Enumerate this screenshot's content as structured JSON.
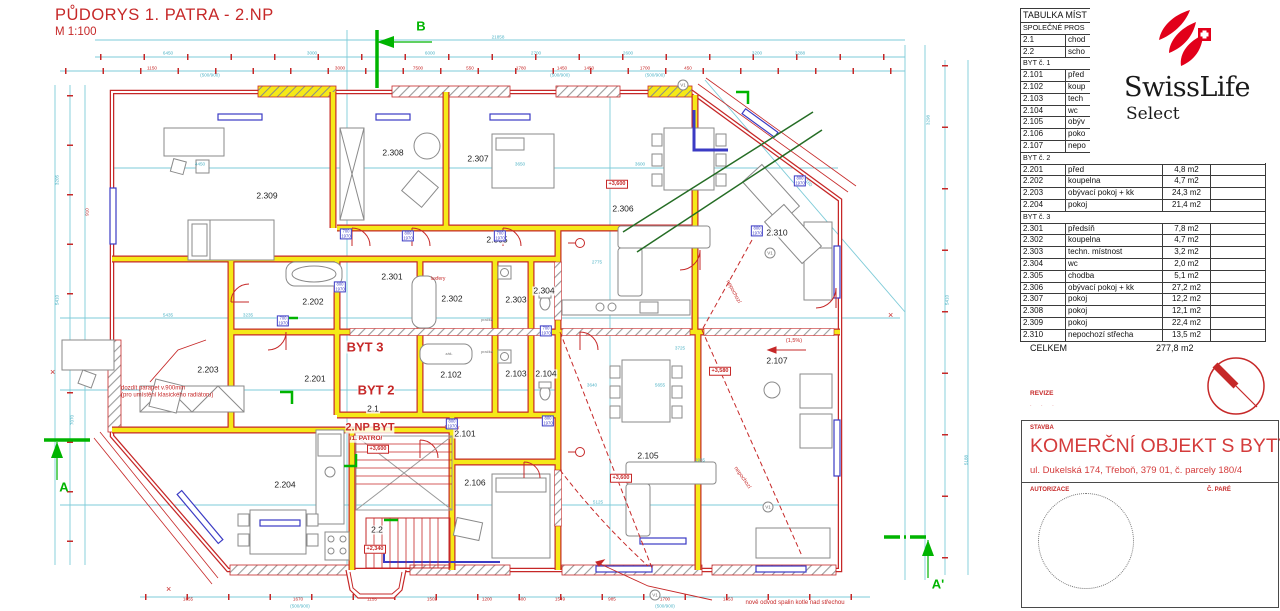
{
  "drawing": {
    "title": "PŮDORYS  1. PATRA - 2.NP",
    "scale": "M 1:100"
  },
  "logo": {
    "brand": "SwissLife",
    "sub": "Select"
  },
  "table": {
    "header": "TABULKA MÍST",
    "rows": [
      {
        "section": "SPOLEČNÉ PROS"
      },
      {
        "id": "2.1",
        "name": "chod",
        "area": ""
      },
      {
        "id": "2.2",
        "name": "scho",
        "area": ""
      },
      {
        "section": "BYT č. 1"
      },
      {
        "id": "2.101",
        "name": "před",
        "area": ""
      },
      {
        "id": "2.102",
        "name": "koup",
        "area": ""
      },
      {
        "id": "2.103",
        "name": "tech",
        "area": ""
      },
      {
        "id": "2.104",
        "name": "wc",
        "area": ""
      },
      {
        "id": "2.105",
        "name": "obýv",
        "area": ""
      },
      {
        "id": "2.106",
        "name": "poko",
        "area": ""
      },
      {
        "id": "2.107",
        "name": "nepo",
        "area": ""
      },
      {
        "section": "BYT č. 2"
      },
      {
        "id": "2.201",
        "name": "před",
        "area": "4,8 m2"
      },
      {
        "id": "2.202",
        "name": "koupelna",
        "area": "4,7 m2"
      },
      {
        "id": "2.203",
        "name": "obývací pokoj + kk",
        "area": "24,3 m2"
      },
      {
        "id": "2.204",
        "name": "pokoj",
        "area": "21,4 m2"
      },
      {
        "section": "BYT č. 3"
      },
      {
        "id": "2.301",
        "name": "předsíň",
        "area": "7,8 m2"
      },
      {
        "id": "2.302",
        "name": "koupelna",
        "area": "4,7 m2"
      },
      {
        "id": "2.303",
        "name": "techn. místnost",
        "area": "3,2 m2"
      },
      {
        "id": "2.304",
        "name": "wc",
        "area": "2,0 m2"
      },
      {
        "id": "2.305",
        "name": "chodba",
        "area": "5,1 m2"
      },
      {
        "id": "2.306",
        "name": "obývací pokoj + kk",
        "area": "27,2 m2"
      },
      {
        "id": "2.307",
        "name": "pokoj",
        "area": "12,2 m2"
      },
      {
        "id": "2.308",
        "name": "pokoj",
        "area": "12,1 m2"
      },
      {
        "id": "2.309",
        "name": "pokoj",
        "area": "22,4 m2"
      },
      {
        "id": "2.310",
        "name": "nepochozí střecha",
        "area": "13,5 m2"
      }
    ],
    "total_label": "CELKEM",
    "total_value": "277,8 m2"
  },
  "revize": {
    "label": "REVIZE",
    "marks": "·  ·        ·"
  },
  "title_block": {
    "stavba_label": "STAVBA",
    "title": "KOMERČNÍ OBJEKT S BYTY",
    "address": "ul. Dukelská 174, Třeboň, 379 01, č. parcely 180/4",
    "autorizace_label": "AUTORIZACE",
    "pare_label": "Č. PARÉ"
  },
  "colors": {
    "red": "#c62828",
    "cyan": "#7ecbd8",
    "blue": "#3b3bc4",
    "yellow": "#f5e918",
    "green": "#00b400",
    "logo_red": "#e2001a"
  },
  "plan": {
    "rooms": [
      {
        "t": "2.309",
        "x": 267,
        "y": 196
      },
      {
        "t": "2.308",
        "x": 393,
        "y": 153
      },
      {
        "t": "2.307",
        "x": 478,
        "y": 159
      },
      {
        "t": "2.306",
        "x": 623,
        "y": 209
      },
      {
        "t": "2.310",
        "x": 777,
        "y": 233
      },
      {
        "t": "2.305",
        "x": 497,
        "y": 240
      },
      {
        "t": "2.301",
        "x": 392,
        "y": 277
      },
      {
        "t": "2.202",
        "x": 313,
        "y": 302
      },
      {
        "t": "2.302",
        "x": 452,
        "y": 299
      },
      {
        "t": "2.303",
        "x": 516,
        "y": 300
      },
      {
        "t": "2.304",
        "x": 544,
        "y": 291
      },
      {
        "t": "2.203",
        "x": 208,
        "y": 370
      },
      {
        "t": "2.201",
        "x": 315,
        "y": 379
      },
      {
        "t": "2.102",
        "x": 451,
        "y": 375
      },
      {
        "t": "2.103",
        "x": 516,
        "y": 374
      },
      {
        "t": "2.104",
        "x": 546,
        "y": 374
      },
      {
        "t": "2.1",
        "x": 373,
        "y": 409
      },
      {
        "t": "2.101",
        "x": 465,
        "y": 434
      },
      {
        "t": "2.106",
        "x": 475,
        "y": 483
      },
      {
        "t": "2.204",
        "x": 285,
        "y": 485
      },
      {
        "t": "2.105",
        "x": 648,
        "y": 456
      },
      {
        "t": "2.107",
        "x": 777,
        "y": 361
      },
      {
        "t": "2.2",
        "x": 377,
        "y": 530
      }
    ],
    "apartments": [
      {
        "t": "BYT 3",
        "x": 365,
        "y": 347,
        "fs": 13
      },
      {
        "t": "BYT 2",
        "x": 376,
        "y": 390,
        "fs": 13
      },
      {
        "t": "2.NP BYT",
        "x": 370,
        "y": 428,
        "fs": 11
      },
      {
        "t": "/1. PATRO/",
        "x": 366,
        "y": 439,
        "fs": 6.5
      }
    ],
    "elevations": [
      {
        "t": "+3,600",
        "x": 617,
        "y": 184
      },
      {
        "t": "+3,600",
        "x": 621,
        "y": 478
      },
      {
        "t": "+3,580",
        "x": 720,
        "y": 371
      },
      {
        "t": "+3,600",
        "x": 378,
        "y": 449
      },
      {
        "t": "+2,340",
        "x": 375,
        "y": 549
      }
    ],
    "annotations": [
      {
        "t": "dozdít parapet v.900mm\n(pro umístění klasického radiátoru)",
        "x": 121,
        "y": 392,
        "align": "left"
      },
      {
        "t": "nově odvod spalin kotle nad střechou",
        "x": 795,
        "y": 603
      },
      {
        "t": "luxfery",
        "x": 438,
        "y": 279,
        "fs": 5
      },
      {
        "t": "luxfery",
        "x": 452,
        "y": 428,
        "fs": 5
      },
      {
        "t": "nepochozí",
        "x": 733,
        "y": 292,
        "rot": 62,
        "fs": 5.5
      },
      {
        "t": "nepochozí",
        "x": 742,
        "y": 478,
        "rot": 55,
        "fs": 5.5
      },
      {
        "t": "(1,5%)",
        "x": 794,
        "y": 341,
        "fs": 5.5
      },
      {
        "t": "pračka",
        "x": 487,
        "y": 320,
        "fs": 4,
        "col": "#777"
      },
      {
        "t": "pračka",
        "x": 487,
        "y": 352,
        "fs": 4,
        "col": "#777"
      },
      {
        "t": "záš.",
        "x": 449,
        "y": 354,
        "fs": 4,
        "col": "#777"
      }
    ],
    "sections": [
      {
        "t": "B",
        "x": 421,
        "y": 26
      },
      {
        "t": "A",
        "x": 64,
        "y": 487
      },
      {
        "t": "A'",
        "x": 938,
        "y": 584
      }
    ],
    "door_labels": [
      {
        "a": "700",
        "b": "1970",
        "x": 346,
        "y": 234
      },
      {
        "a": "800",
        "b": "1970",
        "x": 408,
        "y": 236
      },
      {
        "a": "700",
        "b": "1970",
        "x": 500,
        "y": 236
      },
      {
        "a": "700",
        "b": "1970",
        "x": 283,
        "y": 321
      },
      {
        "a": "800",
        "b": "1970",
        "x": 452,
        "y": 424
      },
      {
        "a": "700",
        "b": "1970",
        "x": 546,
        "y": 331
      },
      {
        "a": "800",
        "b": "1970",
        "x": 548,
        "y": 421
      },
      {
        "a": "800",
        "b": "1970",
        "x": 800,
        "y": 181
      },
      {
        "a": "800",
        "b": "1970",
        "x": 757,
        "y": 231
      },
      {
        "a": "800",
        "b": "1970",
        "x": 340,
        "y": 287
      }
    ],
    "v_markers": [
      {
        "t": "V1",
        "x": 683,
        "y": 85
      },
      {
        "t": "V1",
        "x": 770,
        "y": 253
      },
      {
        "t": "V1",
        "x": 768,
        "y": 507
      },
      {
        "t": "V1",
        "x": 655,
        "y": 595
      }
    ],
    "dims": [
      {
        "t": "21858",
        "x": 498,
        "y": 37,
        "c": "c"
      },
      {
        "t": "6450",
        "x": 168,
        "y": 53,
        "c": "c"
      },
      {
        "t": "3000",
        "x": 312,
        "y": 53,
        "c": "c"
      },
      {
        "t": "6000",
        "x": 430,
        "y": 53,
        "c": "c"
      },
      {
        "t": "2700",
        "x": 536,
        "y": 53,
        "c": "c"
      },
      {
        "t": "2600",
        "x": 628,
        "y": 53,
        "c": "c"
      },
      {
        "t": "3200",
        "x": 757,
        "y": 53,
        "c": "c"
      },
      {
        "t": "3288",
        "x": 800,
        "y": 53,
        "c": "c"
      },
      {
        "t": "1150",
        "x": 152,
        "y": 68,
        "c": "r"
      },
      {
        "t": "3000",
        "x": 340,
        "y": 68,
        "c": "r"
      },
      {
        "t": "7500",
        "x": 418,
        "y": 68,
        "c": "r"
      },
      {
        "t": "550",
        "x": 470,
        "y": 68,
        "c": "r"
      },
      {
        "t": "1780",
        "x": 521,
        "y": 68,
        "c": "r"
      },
      {
        "t": "1450",
        "x": 562,
        "y": 68,
        "c": "r"
      },
      {
        "t": "1450",
        "x": 589,
        "y": 68,
        "c": "r"
      },
      {
        "t": "1700",
        "x": 645,
        "y": 68,
        "c": "r"
      },
      {
        "t": "450",
        "x": 688,
        "y": 68,
        "c": "r"
      },
      {
        "t": "(500/900)",
        "x": 210,
        "y": 75,
        "c": "c"
      },
      {
        "t": "(500/900)",
        "x": 560,
        "y": 75,
        "c": "c"
      },
      {
        "t": "(500/900)",
        "x": 655,
        "y": 75,
        "c": "c"
      },
      {
        "t": "4450",
        "x": 200,
        "y": 164,
        "c": "c"
      },
      {
        "t": "3650",
        "x": 520,
        "y": 164,
        "c": "c"
      },
      {
        "t": "3600",
        "x": 640,
        "y": 164,
        "c": "c"
      },
      {
        "t": "2775",
        "x": 597,
        "y": 262,
        "c": "c"
      },
      {
        "t": "5435",
        "x": 168,
        "y": 315,
        "c": "c"
      },
      {
        "t": "3235",
        "x": 248,
        "y": 315,
        "c": "c"
      },
      {
        "t": "3640",
        "x": 592,
        "y": 385,
        "c": "c"
      },
      {
        "t": "5655",
        "x": 660,
        "y": 385,
        "c": "c"
      },
      {
        "t": "5125",
        "x": 598,
        "y": 502,
        "c": "c"
      },
      {
        "t": "2985",
        "x": 700,
        "y": 460,
        "c": "c"
      },
      {
        "t": "3725",
        "x": 680,
        "y": 348,
        "c": "c"
      },
      {
        "t": "5410",
        "x": 57,
        "y": 300,
        "c": "c",
        "rot": -90
      },
      {
        "t": "7070",
        "x": 72,
        "y": 420,
        "c": "c",
        "rot": -90
      },
      {
        "t": "3205",
        "x": 57,
        "y": 180,
        "c": "c",
        "rot": -90
      },
      {
        "t": "910",
        "x": 87,
        "y": 212,
        "c": "r",
        "rot": -90
      },
      {
        "t": "5160",
        "x": 808,
        "y": 182,
        "c": "c",
        "rot": 48
      },
      {
        "t": "5410",
        "x": 947,
        "y": 300,
        "c": "c",
        "rot": -90
      },
      {
        "t": "5188",
        "x": 966,
        "y": 460,
        "c": "c",
        "rot": -90
      },
      {
        "t": "3298",
        "x": 928,
        "y": 120,
        "c": "c",
        "rot": -90
      },
      {
        "t": "1655",
        "x": 188,
        "y": 599,
        "c": "r"
      },
      {
        "t": "1670",
        "x": 298,
        "y": 599,
        "c": "r"
      },
      {
        "t": "1155",
        "x": 372,
        "y": 599,
        "c": "r"
      },
      {
        "t": "1502",
        "x": 432,
        "y": 599,
        "c": "r"
      },
      {
        "t": "1200",
        "x": 487,
        "y": 599,
        "c": "r"
      },
      {
        "t": "600",
        "x": 522,
        "y": 599,
        "c": "r"
      },
      {
        "t": "1549",
        "x": 560,
        "y": 599,
        "c": "r"
      },
      {
        "t": "985",
        "x": 612,
        "y": 599,
        "c": "r"
      },
      {
        "t": "1700",
        "x": 665,
        "y": 599,
        "c": "r"
      },
      {
        "t": "1353",
        "x": 728,
        "y": 599,
        "c": "r"
      },
      {
        "t": "(500/900)",
        "x": 300,
        "y": 606,
        "c": "c"
      },
      {
        "t": "(500/900)",
        "x": 665,
        "y": 606,
        "c": "c"
      }
    ]
  }
}
